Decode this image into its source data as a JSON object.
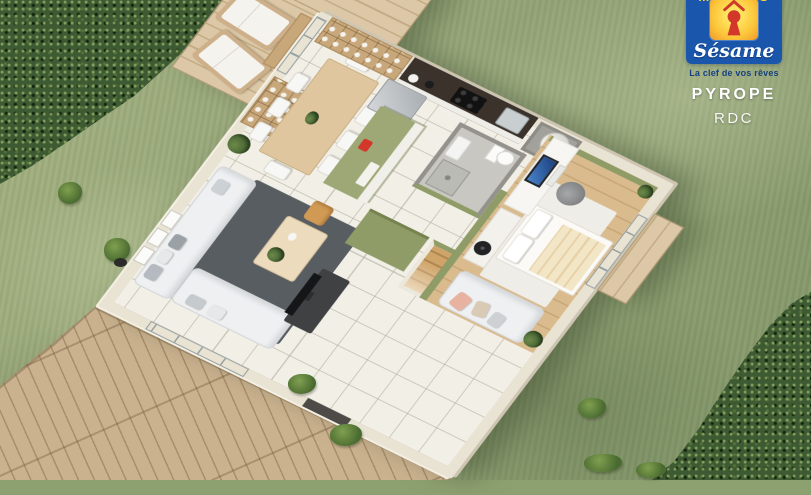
{
  "brand": {
    "name_top": "MAISONS",
    "logo_text": "Sésame",
    "tagline": "La clef de vos rêves",
    "project": "PYROPE",
    "floor": "RDC"
  },
  "colors": {
    "logo_blue": "#1a57ac",
    "logo_yellow_text": "#ffd23a",
    "keyhole_red": "#d2372a",
    "tagline_blue": "#16417f",
    "grass": "#95a577",
    "hedge": "#3e5a33",
    "deck_wood": "#c6ad8b",
    "wall_cream": "#e9e3d4",
    "tile_floor": "#f2efe7",
    "accent_sage": "#8f9c67",
    "island_sage": "#9da876",
    "rug_charcoal": "#585d62",
    "bedroom_wood": "#d9bb8e"
  }
}
